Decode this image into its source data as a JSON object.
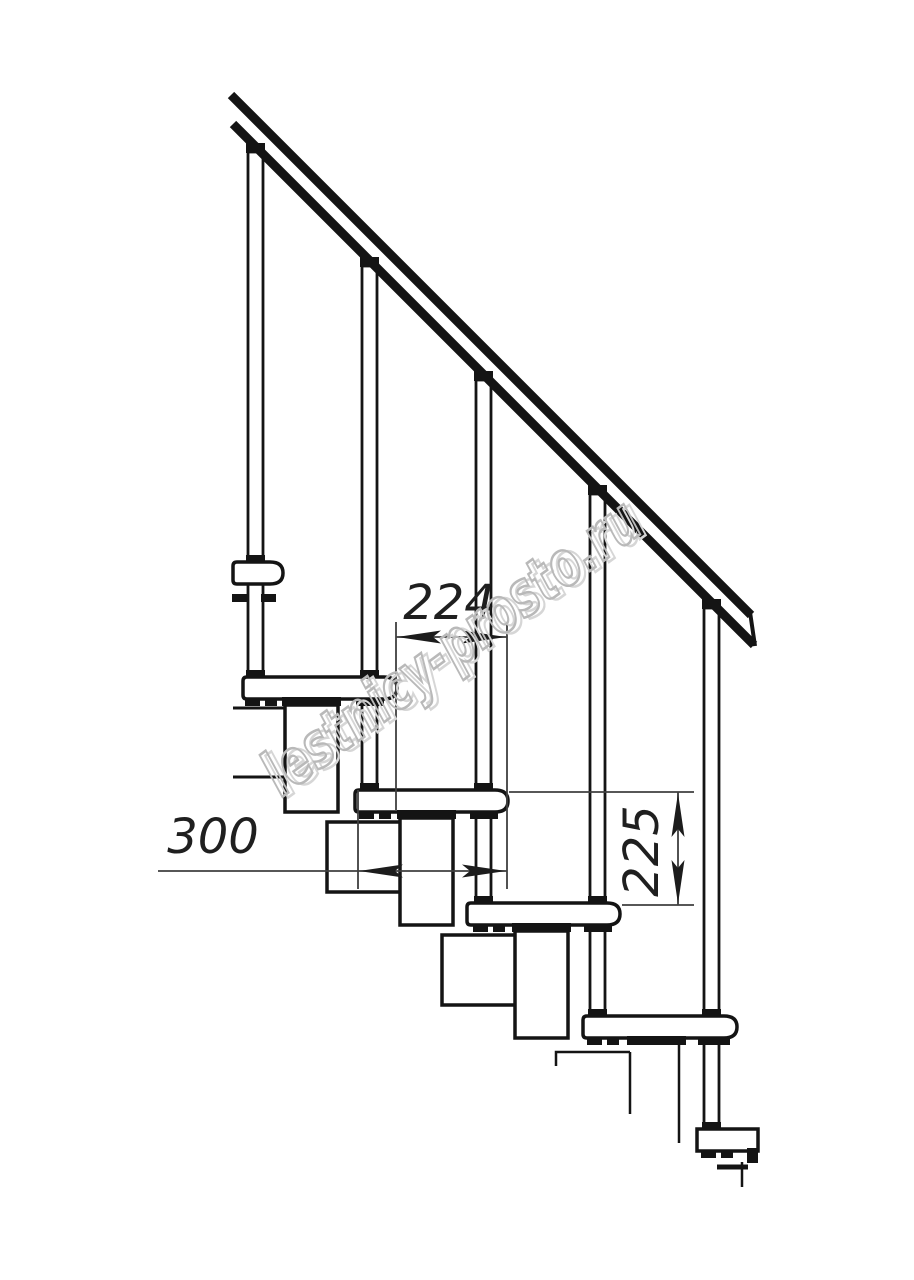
{
  "drawing": {
    "dimension_labels": {
      "going": "224",
      "module_length": "300",
      "riser": "225"
    },
    "watermark_text": "lestnicy-prosto.ru",
    "colors": {
      "ink": "#141414",
      "dim": "#3f3f3f",
      "dim_fill": "#1c1c1c",
      "text": "#1f1f1f",
      "watermark_front": "#b9b9b9",
      "watermark_back": "#d6d6d6",
      "background": "#ffffff"
    }
  }
}
